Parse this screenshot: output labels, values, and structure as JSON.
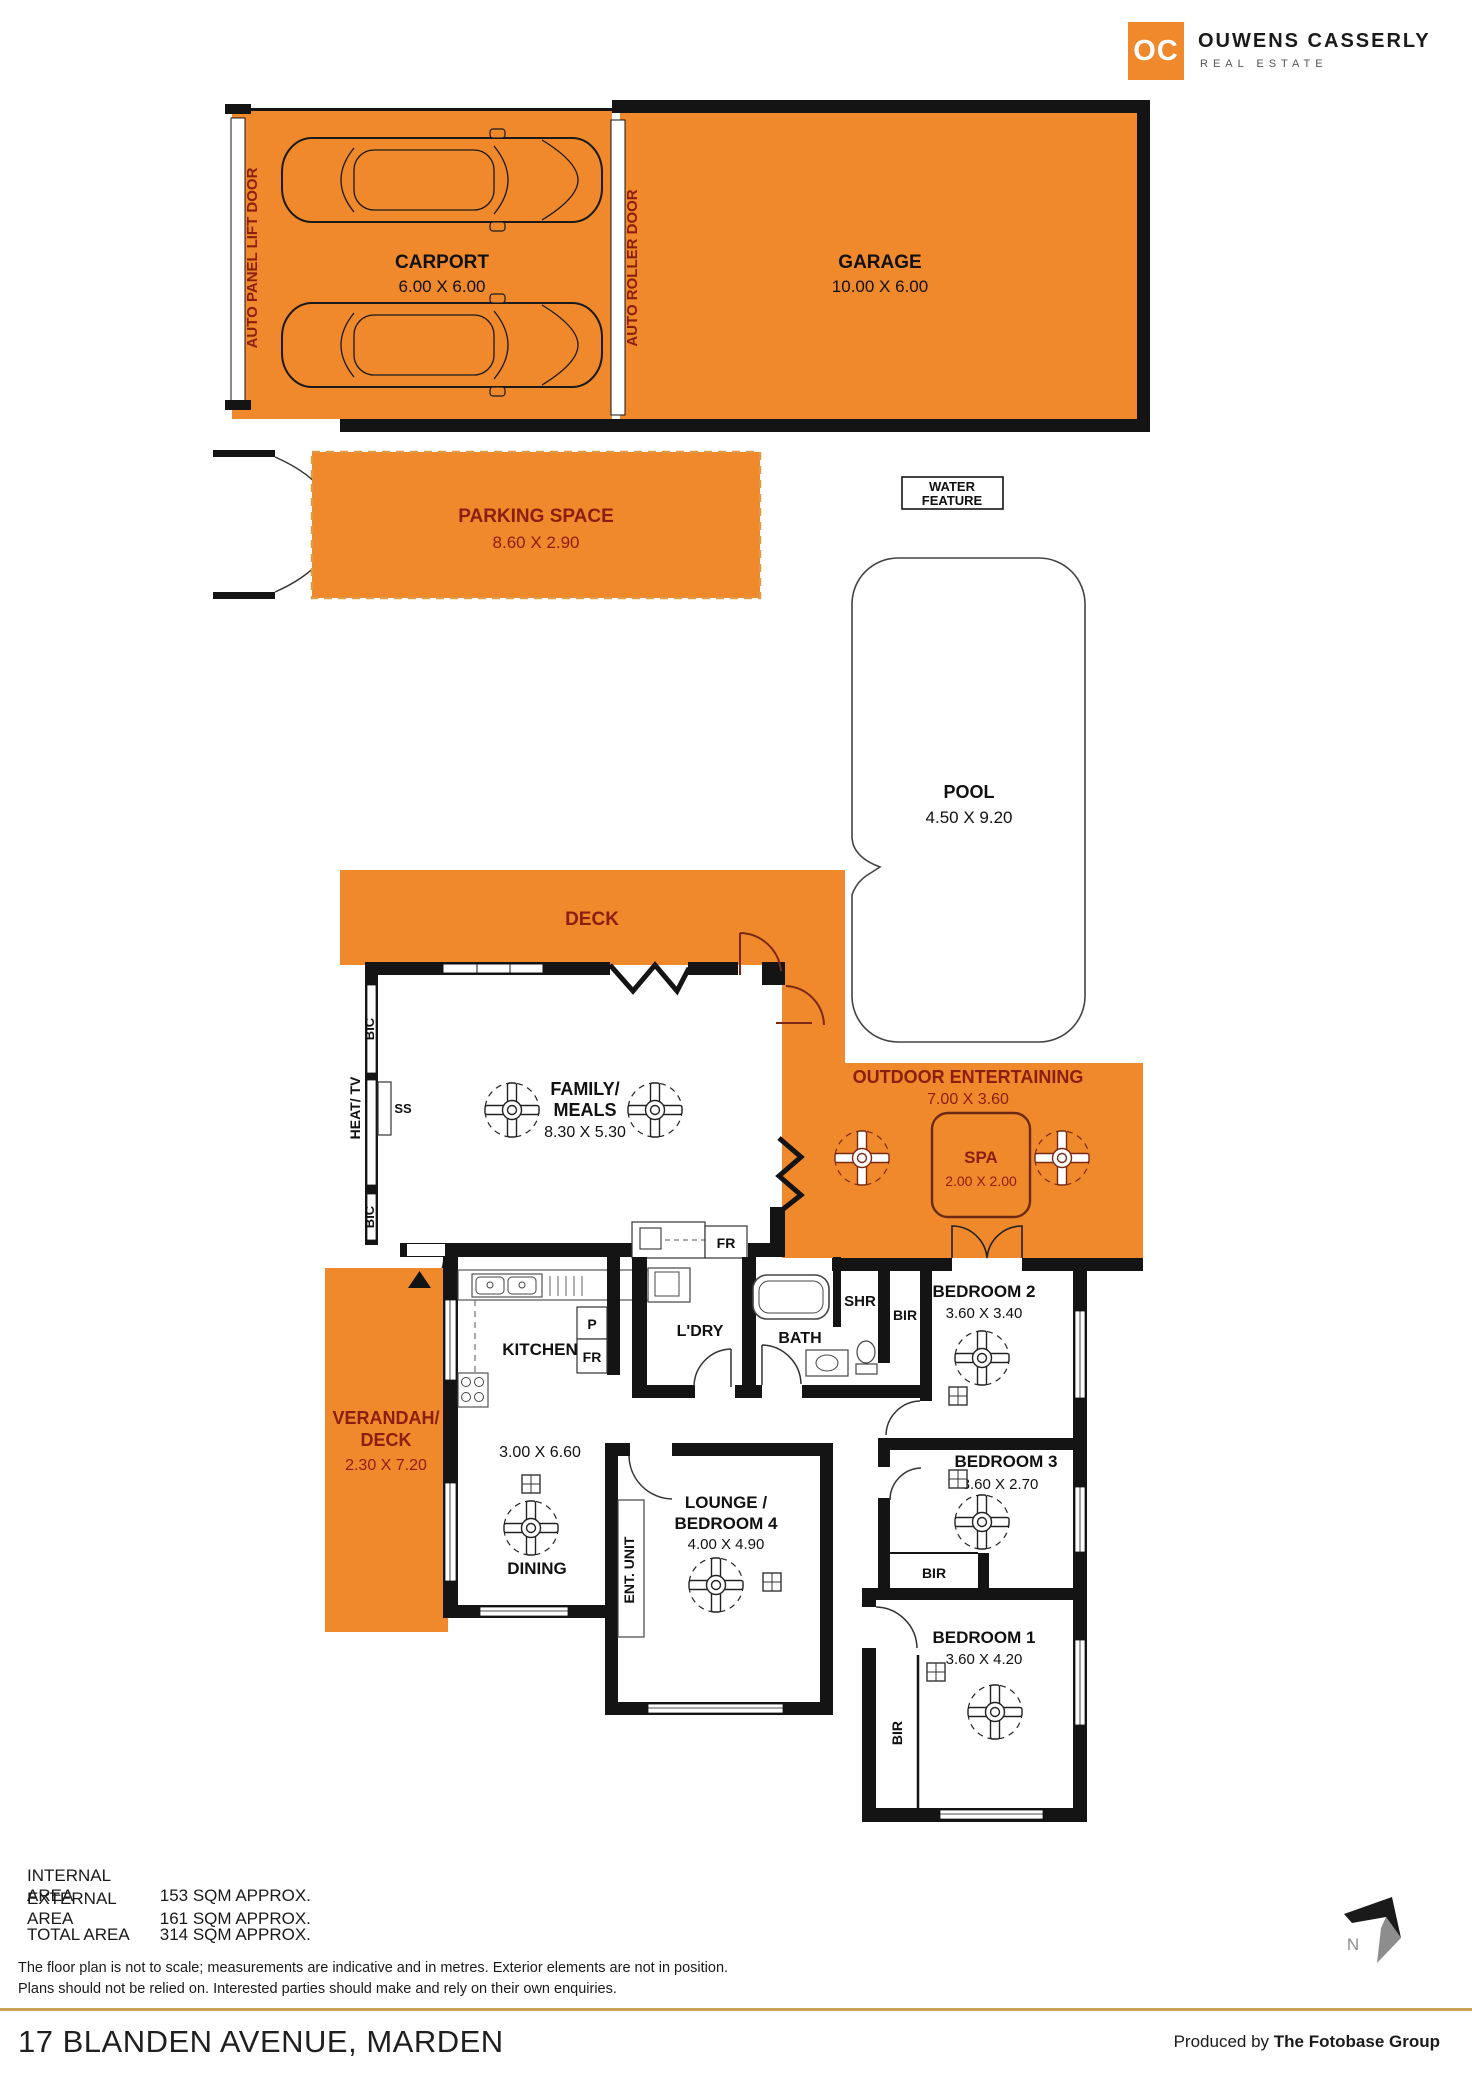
{
  "brand": {
    "logo_mark": "OC",
    "name": "OUWENS CASSERLY",
    "tagline": "REAL ESTATE"
  },
  "rooms": {
    "carport": {
      "name": "CARPORT",
      "dims": "6.00 X 6.00"
    },
    "garage": {
      "name": "GARAGE",
      "dims": "10.00 X 6.00"
    },
    "parking": {
      "name": "PARKING SPACE",
      "dims": "8.60 X 2.90"
    },
    "water_feature": {
      "line1": "WATER",
      "line2": "FEATURE"
    },
    "pool": {
      "name": "POOL",
      "dims": "4.50 X 9.20"
    },
    "deck": {
      "name": "DECK"
    },
    "family": {
      "name1": "FAMILY/",
      "name2": "MEALS",
      "dims": "8.30 X 5.30"
    },
    "outdoor": {
      "name": "OUTDOOR ENTERTAINING",
      "dims": "7.00 X 3.60"
    },
    "spa": {
      "name": "SPA",
      "dims": "2.00 X 2.00"
    },
    "verandah": {
      "name1": "VERANDAH/",
      "name2": "DECK",
      "dims": "2.30 X 7.20"
    },
    "kitchen": {
      "name": "KITCHEN",
      "dims": "3.00 X 6.60"
    },
    "dining": {
      "name": "DINING"
    },
    "ldry": {
      "name": "L'DRY"
    },
    "bath": {
      "name": "BATH"
    },
    "shr": {
      "name": "SHR"
    },
    "lounge": {
      "name1": "LOUNGE /",
      "name2": "BEDROOM 4",
      "dims": "4.00 X 4.90"
    },
    "bed1": {
      "name": "BEDROOM 1",
      "dims": "3.60 X 4.20"
    },
    "bed2": {
      "name": "BEDROOM 2",
      "dims": "3.60 X 3.40"
    },
    "bed3": {
      "name": "BEDROOM 3",
      "dims": "3.60 X 2.70"
    }
  },
  "labels": {
    "auto_panel": "AUTO PANEL LIFT DOOR",
    "auto_roller": "AUTO ROLLER DOOR",
    "bir": "BIR",
    "bic": "BIC",
    "heat_tv": "HEAT/ TV",
    "ss": "SS",
    "p": "P",
    "fr": "FR",
    "ent_unit": "ENT. UNIT",
    "north": "N"
  },
  "areas": {
    "internal": {
      "label": "INTERNAL AREA",
      "value": "153 SQM APPROX."
    },
    "external": {
      "label": "EXTERNAL AREA",
      "value": "161 SQM APPROX."
    },
    "total": {
      "label": "TOTAL AREA",
      "value": "314 SQM APPROX."
    }
  },
  "disclaimer": {
    "line1": "The floor plan is not to scale; measurements are indicative and in metres. Exterior elements are not in position.",
    "line2": "Plans should not be relied on. Interested parties should make and rely on their own enquiries."
  },
  "footer": {
    "address": "17 BLANDEN AVENUE, MARDEN",
    "produced_prefix": "Produced by ",
    "produced_by": "The Fotobase Group"
  },
  "colors": {
    "orange": "#F0882C",
    "maroon": "#8A1F0F",
    "wall": "#141414",
    "gold": "#C9A254"
  }
}
